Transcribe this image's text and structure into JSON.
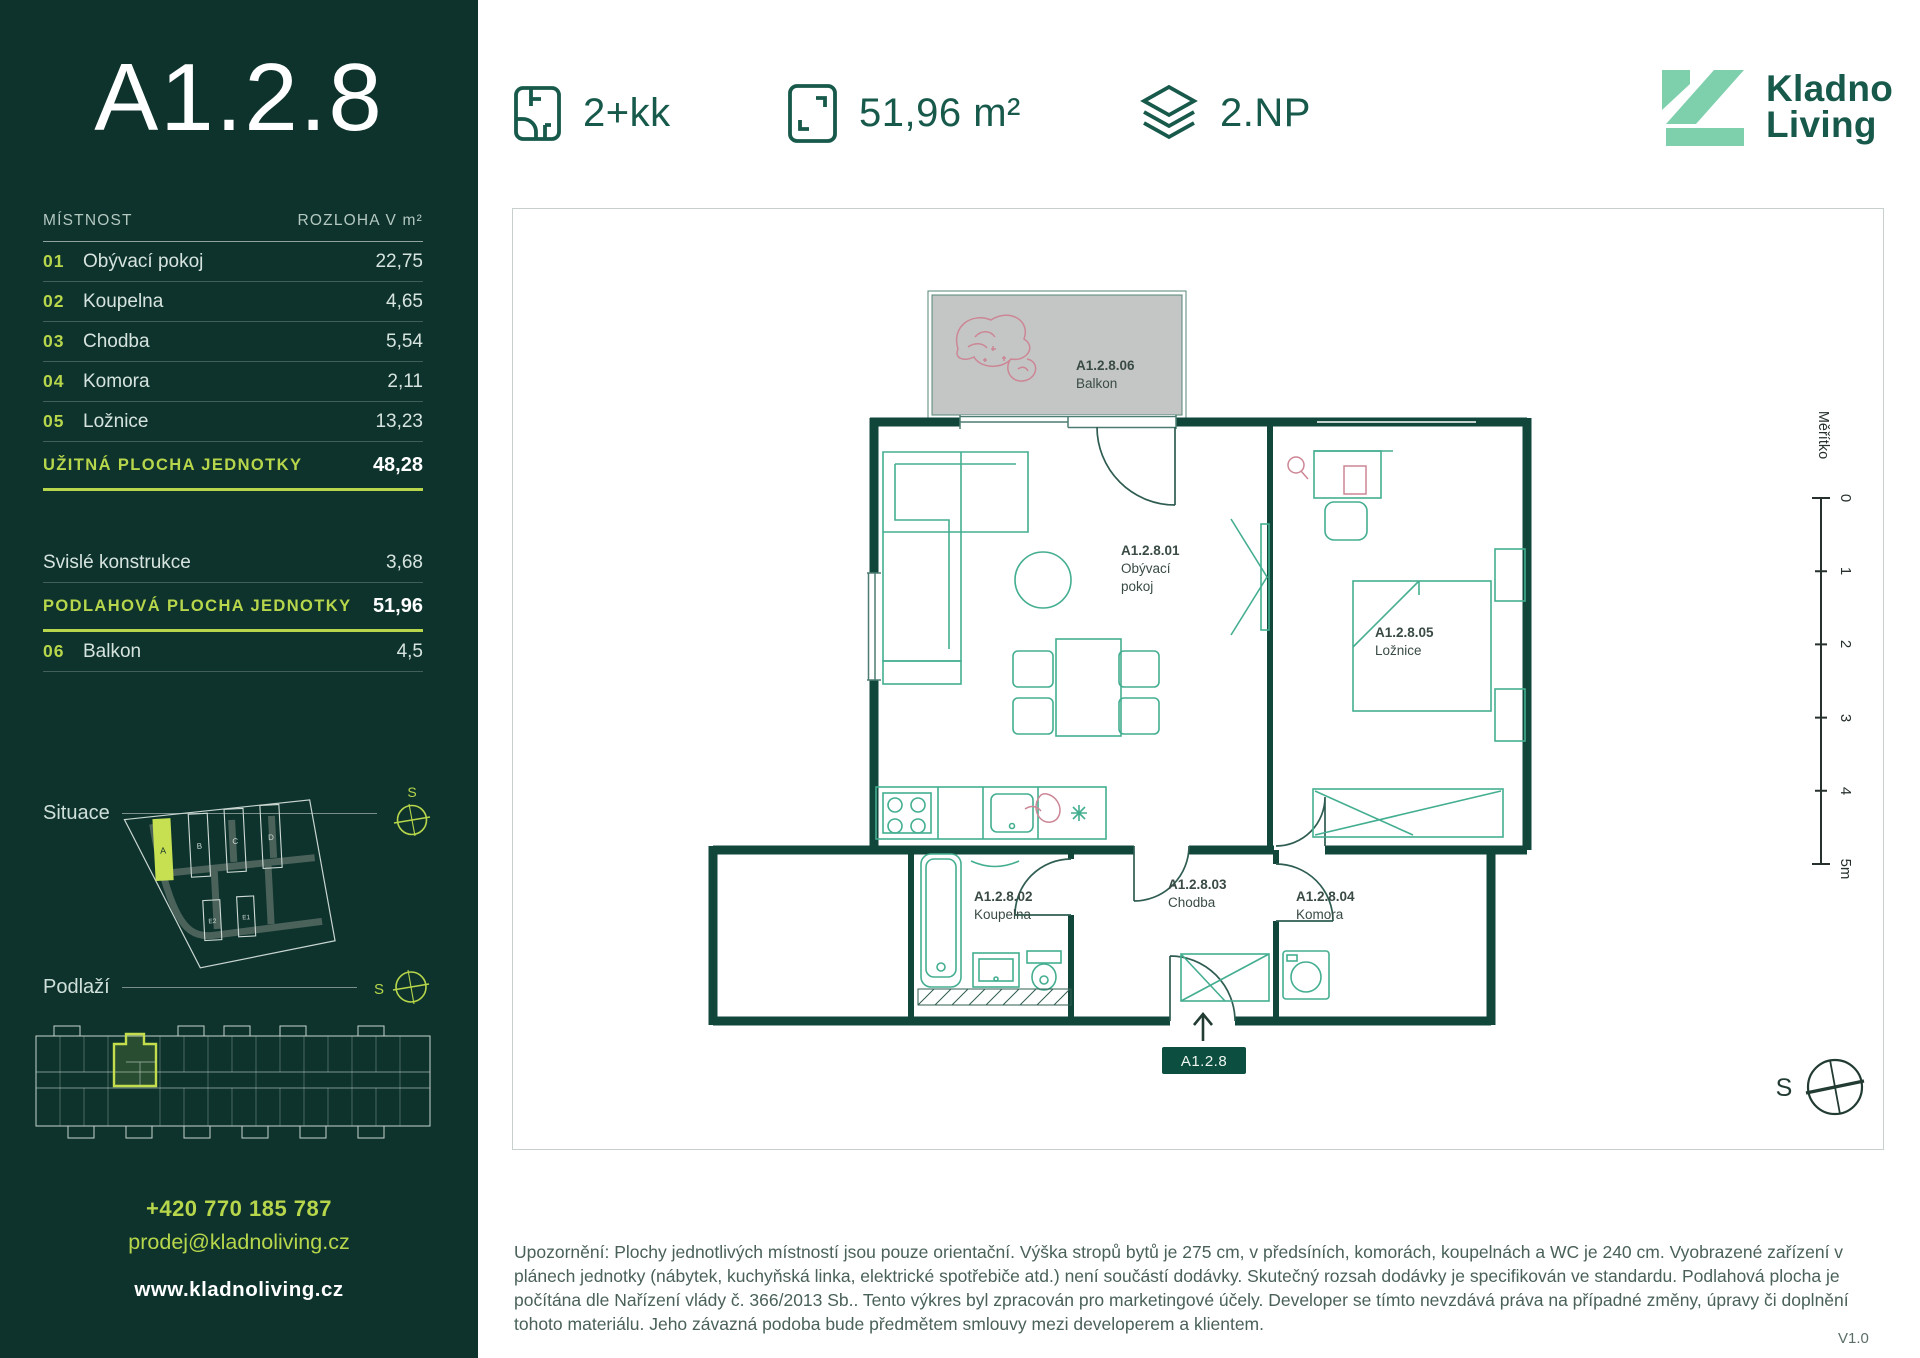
{
  "colors": {
    "accent": "#b7d64b",
    "sidebar_bg": "#0d332c",
    "brand_green": "#17594a",
    "brand_mint": "#7ed0ad",
    "wall": "#11463b",
    "furniture": "#44ae90",
    "pink": "#cc8695",
    "balcony_gray": "#c4c6c5"
  },
  "sidebar": {
    "unit_id": "A1.2.8",
    "table": {
      "col_room": "MÍSTNOST",
      "col_area": "ROZLOHA V m²",
      "rows": [
        {
          "num": "01",
          "name": "Obývací pokoj",
          "area": "22,75"
        },
        {
          "num": "02",
          "name": "Koupelna",
          "area": "4,65"
        },
        {
          "num": "03",
          "name": "Chodba",
          "area": "5,54"
        },
        {
          "num": "04",
          "name": "Komora",
          "area": "2,11"
        },
        {
          "num": "05",
          "name": "Ložnice",
          "area": "13,23"
        }
      ],
      "usable": {
        "label": "UŽITNÁ PLOCHA JEDNOTKY",
        "value": "48,28"
      },
      "vertical": {
        "label": "Svislé konstrukce",
        "value": "3,68"
      },
      "floor_area": {
        "label": "PODLAHOVÁ PLOCHA JEDNOTKY",
        "value": "51,96"
      },
      "balcony": {
        "num": "06",
        "name": "Balkon",
        "area": "4,5"
      }
    },
    "situace_label": "Situace",
    "podlazi_label": "Podlaží",
    "compass_letter": "S",
    "site_buildings": {
      "a": "A",
      "b": "B",
      "c": "C",
      "d": "D",
      "e2": "E2",
      "e1": "E1"
    },
    "contact": {
      "phone": "+420 770 185 787",
      "email": "prodej@kladnoliving.cz",
      "website": "www.kladnoliving.cz"
    }
  },
  "header": {
    "layout": "2+kk",
    "area": "51,96 m²",
    "floor": "2.NP",
    "brand_line1": "Kladno",
    "brand_line2": "Living"
  },
  "floorplan": {
    "unit_badge": "A1.2.8",
    "rooms": {
      "living": {
        "id": "A1.2.8.01",
        "name1": "Obývací",
        "name2": "pokoj"
      },
      "bathroom": {
        "id": "A1.2.8.02",
        "name": "Koupelna"
      },
      "hall": {
        "id": "A1.2.8.03",
        "name": "Chodba"
      },
      "storage": {
        "id": "A1.2.8.04",
        "name": "Komora"
      },
      "bedroom": {
        "id": "A1.2.8.05",
        "name": "Ložnice"
      },
      "balcony": {
        "id": "A1.2.8.06",
        "name": "Balkon"
      }
    },
    "scale": {
      "label": "Měřítko",
      "t0": "0",
      "t1": "1",
      "t2": "2",
      "t3": "3",
      "t4": "4",
      "t5": "5m"
    },
    "compass_letter": "S"
  },
  "footer": {
    "disclaimer": "Upozornění: Plochy jednotlivých místností jsou pouze orientační. Výška stropů bytů je 275 cm, v předsíních, komorách, koupelnách a WC je 240 cm. Vyobrazené zařízení v plánech jednotky (nábytek, kuchyňská linka, elektrické spotřebiče atd.) není součástí dodávky. Skutečný rozsah dodávky je specifikován ve standardu. Podlahová plocha je počítána dle Nařízení vlády č. 366/2013 Sb.. Tento výkres byl zpracován pro marketingové účely. Developer se tímto nevzdává práva na případné změny, úpravy či doplnění tohoto materiálu. Jeho závazná podoba bude předmětem smlouvy mezi developerem a klientem.",
    "version": "V1.0"
  }
}
